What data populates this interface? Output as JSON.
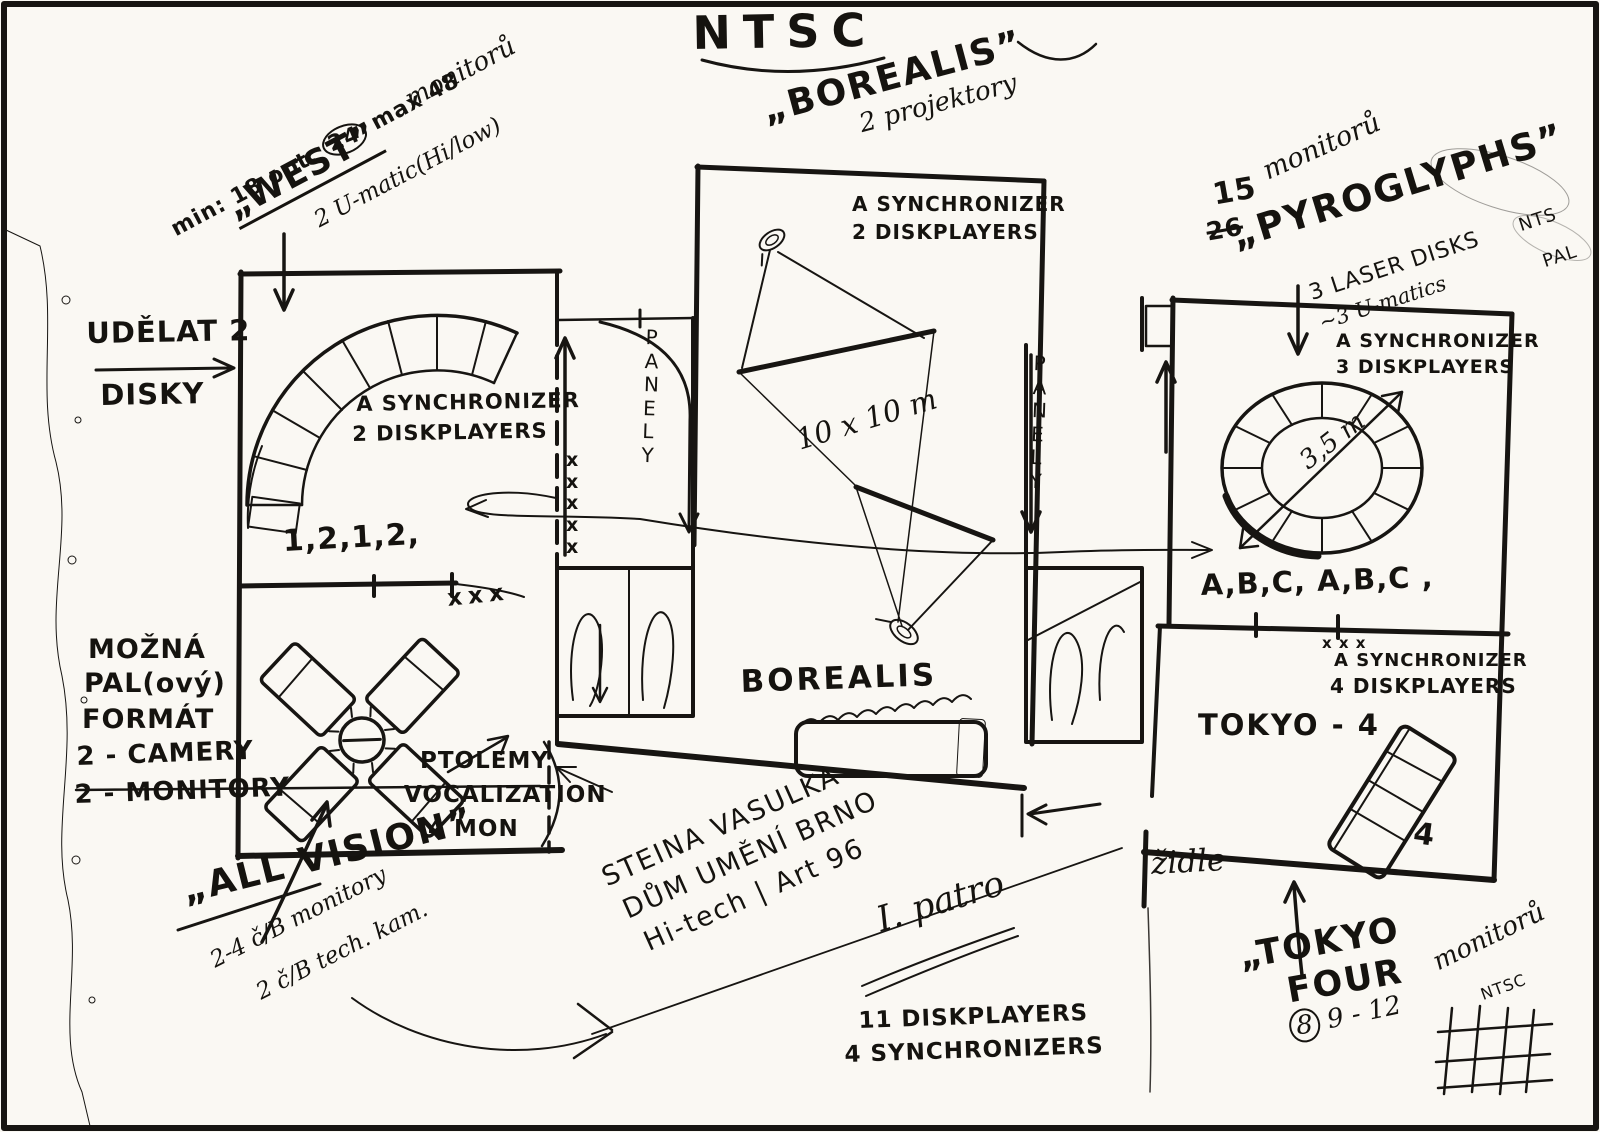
{
  "title": {
    "main": "NTSC"
  },
  "west": {
    "note": "min: 18 opt.",
    "circled": "24",
    "note2": "max 48",
    "monitors": "monitorů",
    "name": "„WEST”",
    "umatic": "2 U-matic(Hi/low)"
  },
  "left_margin": {
    "udelat": "UDĚLAT 2",
    "disky": "DISKY",
    "mozna": "MOŽNÁ",
    "pal": "PAL(ový)",
    "format": "FORMÁT",
    "camery": "2 - CAMERY",
    "monitory": "2 - MONITORY"
  },
  "west_room": {
    "sync": "A SYNCHRONIZER",
    "disk": "2 DISKPLAYERS",
    "seq": "1,2,1,2,",
    "xxx": "xxx",
    "xcol": "x\nx\nx\nx\nx"
  },
  "all_vision": {
    "name": "„ALL VISION”",
    "note1": "2-4 č/B monitory",
    "note2": "2 č/B tech. kam."
  },
  "ptolemy": {
    "l1": "PTOLEMY",
    "l2": "VOCALIZATION",
    "l3": "4 MON"
  },
  "borealis": {
    "name": "„BOREALIS”",
    "projectors": "2 projektory",
    "sync": "A SYNCHRONIZER",
    "disk": "2 DISKPLAYERS",
    "dims": "10 x 10 m",
    "label": "BOREALIS"
  },
  "corridors": {
    "panely_left": "P\nA\nN\nE\nL\nY",
    "panely_right": "P\nA\nN\nE\nL\nY"
  },
  "pyroglyphs": {
    "count": "15",
    "count_old": "26",
    "monitors": "monitorů",
    "name": "„PYROGLYPHS”",
    "laser": "3 LASER DISKS",
    "laser_fmt": "NTS",
    "umatic": "~3 U-matics",
    "umatic_fmt": "PAL",
    "sync": "A SYNCHRONIZER",
    "disk": "3 DISKPLAYERS",
    "diameter": "3,5 m",
    "abc": "A,B,C, A,B,C ,"
  },
  "tokyo": {
    "xxx": "x x x",
    "sync": "A SYNCHRONIZER",
    "disk": "4 DISKPLAYERS",
    "room": "TOKYO - 4",
    "four": "4",
    "zidle": "židle",
    "name_line1": "„TOKYO",
    "name_line2": "FOUR",
    "count_circled": "8",
    "count": "9 - 12",
    "monitors": "monitorů",
    "format": "NTSC"
  },
  "footer": {
    "artist": "STEINA VASULKA",
    "venue": "DŮM UMĚNÍ BRNO",
    "event": "Hi-tech | Art 96",
    "floor": "I. patro",
    "disk": "11 DISKPLAYERS",
    "sync": "4 SYNCHRONIZERS"
  }
}
